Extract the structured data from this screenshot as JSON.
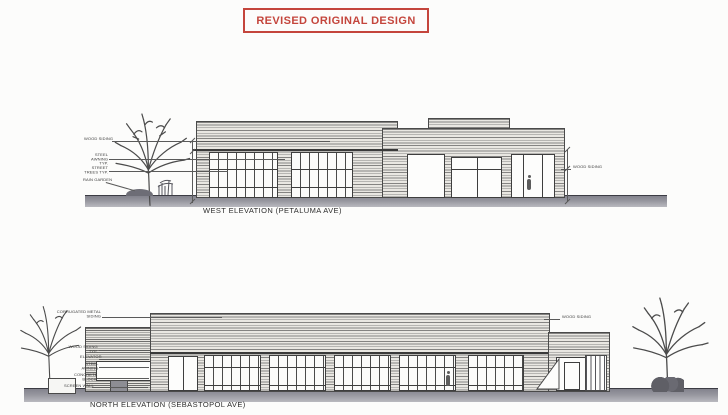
{
  "title": {
    "text": "REVISED ORIGINAL DESIGN",
    "color": "#c4453c"
  },
  "west": {
    "caption": "WEST ELEVATION (PETALUMA AVE)",
    "labels": {
      "wood_siding": "WOOD SIDING",
      "steel_awning": "STEEL AWNING TYP.",
      "street_trees": "STREET TREES TYP.",
      "rain_garden": "RAIN GARDEN",
      "wood_siding_right": "WOOD SIDING"
    }
  },
  "north": {
    "caption": "NORTH ELEVATION (SEBASTOPOL AVE)",
    "labels": {
      "corrugated": "CORRUGATED METAL SIDING",
      "wood_siding": "WOOD SIDING TYP.",
      "elevator": "ELEVATOR",
      "steel_awning": "STEEL AWNING",
      "concrete_block": "CONCRETE BLOCK",
      "screen_wall": "SCREEN WALL",
      "wood_siding_right": "WOOD SIDING"
    }
  }
}
